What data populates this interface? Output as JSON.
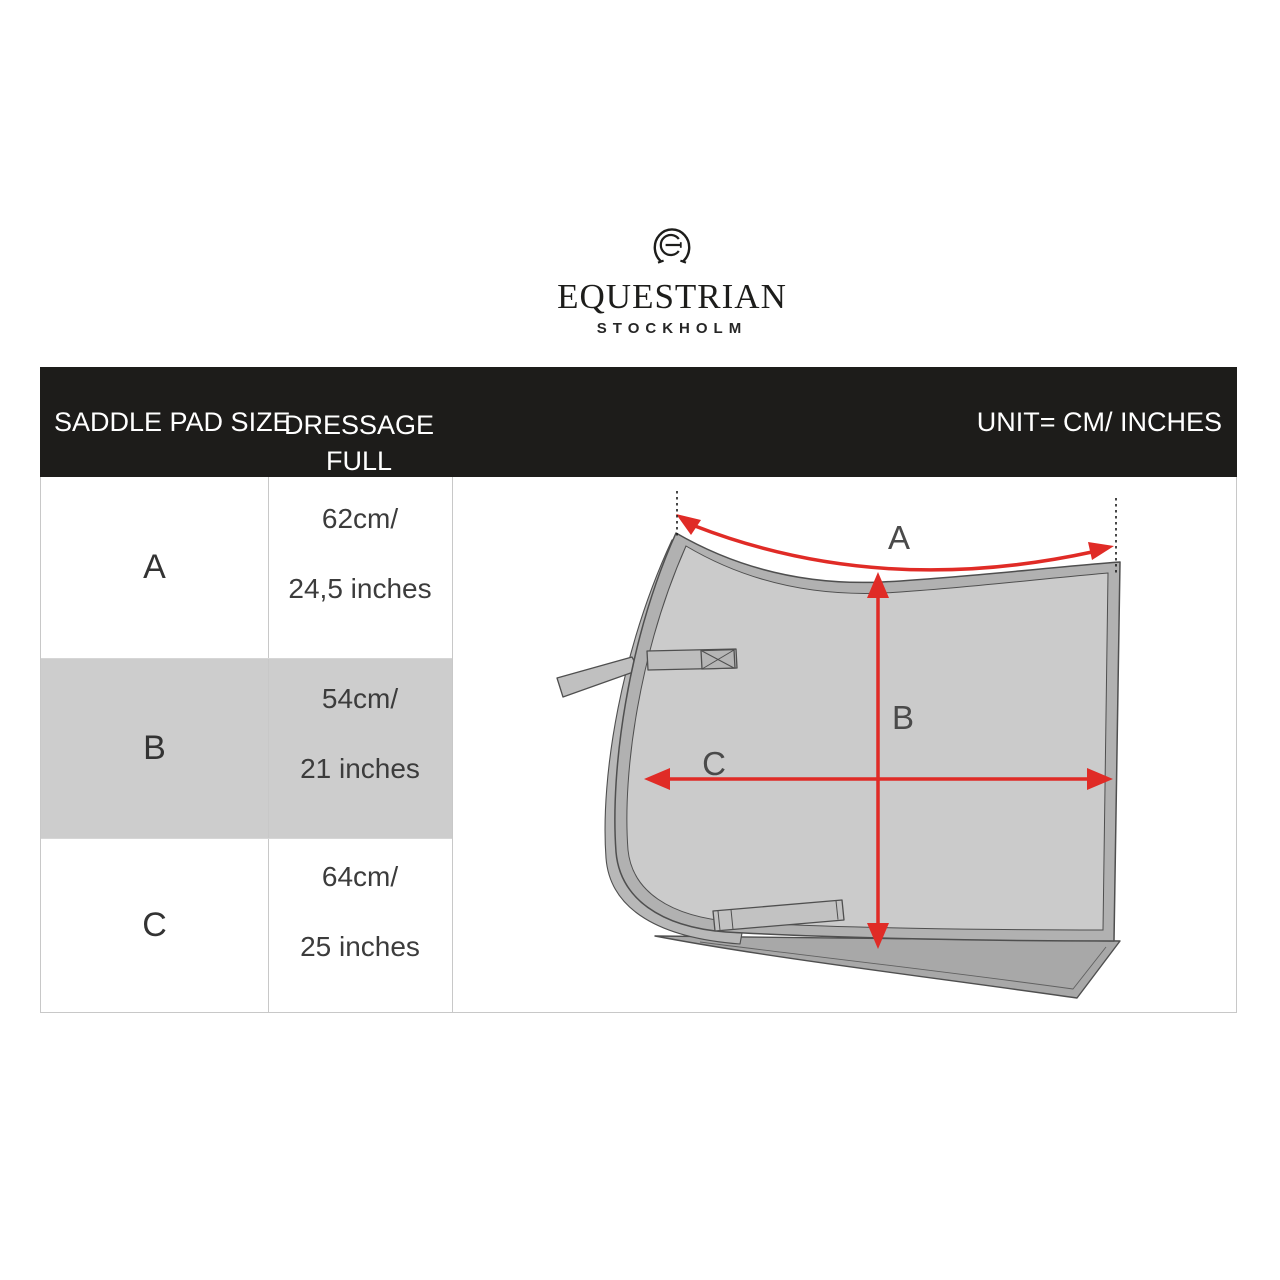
{
  "brand": {
    "name": "EQUESTRIAN",
    "city": "STOCKHOLM",
    "emblem": "horseshoe-monogram-icon"
  },
  "header": {
    "col_size": "SADDLE PAD SIZE",
    "col_product_line1": "DRESSAGE",
    "col_product_line2": "FULL",
    "unit": "UNIT= CM/ INCHES",
    "bg": "#1d1c1a",
    "text_color": "#ffffff"
  },
  "table": {
    "rows": [
      {
        "size": "A",
        "cm": "62cm/",
        "inches": "24,5 inches",
        "highlighted": false
      },
      {
        "size": "B",
        "cm": "54cm/",
        "inches": "21 inches",
        "highlighted": true
      },
      {
        "size": "C",
        "cm": "64cm/",
        "inches": "25 inches",
        "highlighted": false
      }
    ],
    "highlight_color": "#cdcdcd",
    "border_color": "#c8c8c8"
  },
  "diagram": {
    "labels": {
      "a": "A",
      "b": "B",
      "c": "C"
    },
    "arrow_color": "#e02b26",
    "pad_fill": "#cbcbcb",
    "trim_fill": "#b1b1b1",
    "underlayer_fill": "#a8a8a8",
    "outline_color": "#4f4f4f",
    "label_color": "#4a4a4a"
  }
}
